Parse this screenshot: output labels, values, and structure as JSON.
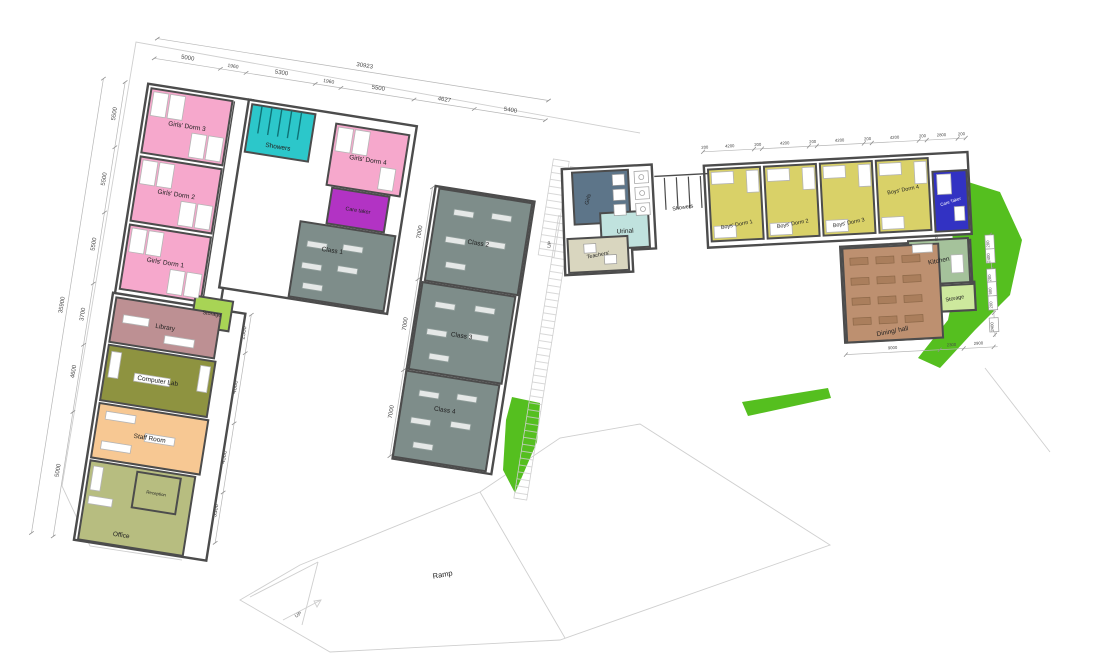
{
  "colors": {
    "green": "#55bf1f",
    "wall": "#4c4c4c",
    "pink": "#f6a8cc",
    "cyan": "#2cc7ca",
    "purple": "#b233c4",
    "class_gray": "#7e8d8a",
    "storage_green": "#a8d455",
    "library_mauve": "#bd9093",
    "lab_olive": "#8e9340",
    "staff_peach": "#f7c893",
    "office_olive": "#b7bd80",
    "toilet_slate": "#5d7589",
    "urinal_aqua": "#c0e2de",
    "teachers_beige": "#d9d6bf",
    "boys_yellow": "#d9d168",
    "caretaker_blue": "#3232c3",
    "kitchen_sage": "#a5c29b",
    "storage_light": "#cde89d",
    "dining_tan": "#bd9070"
  },
  "rooms": {
    "girls_dorm_3": {
      "label": "Girls' Dorm 3",
      "color": "#f6a8cc"
    },
    "girls_dorm_2": {
      "label": "Girls' Dorm 2",
      "color": "#f6a8cc"
    },
    "girls_dorm_1": {
      "label": "Girls' Dorm 1",
      "color": "#f6a8cc"
    },
    "girls_showers": {
      "label": "Showers",
      "color": "#2cc7ca"
    },
    "girls_dorm_4": {
      "label": "Girls' Dorm 4",
      "color": "#f6a8cc"
    },
    "care_taker_left": {
      "label": "Care taker",
      "color": "#b233c4"
    },
    "class_1": {
      "label": "Class 1",
      "color": "#7e8d8a"
    },
    "class_2": {
      "label": "Class 2",
      "color": "#7e8d8a"
    },
    "class_3": {
      "label": "Class 3",
      "color": "#7e8d8a"
    },
    "class_4": {
      "label": "Class 4",
      "color": "#7e8d8a"
    },
    "storage_left": {
      "label": "Storage",
      "color": "#a8d455"
    },
    "library": {
      "label": "Library",
      "color": "#bd9093"
    },
    "computer_lab": {
      "label": "Computer Lab",
      "color": "#8e9340"
    },
    "staff_room": {
      "label": "Staff Room",
      "color": "#f7c893"
    },
    "reception": {
      "label": "Reception",
      "color": "#b7bd80"
    },
    "office": {
      "label": "Office",
      "color": "#b7bd80"
    },
    "girls_toilets": {
      "label": "Girls",
      "color": "#5d7589"
    },
    "urinal": {
      "label": "Urinal",
      "color": "#c0e2de"
    },
    "teachers": {
      "label": "Teachers'",
      "color": "#d9d6bf"
    },
    "boys_showers": {
      "label": "Showers",
      "color": "#ffffff"
    },
    "boys_dorm_1": {
      "label": "Boys' Dorm 1",
      "color": "#d9d168"
    },
    "boys_dorm_2": {
      "label": "Boys' Dorm 2",
      "color": "#d9d168"
    },
    "boys_dorm_3": {
      "label": "Boys' Dorm 3",
      "color": "#d9d168"
    },
    "boys_dorm_4": {
      "label": "Boys' Dorm 4",
      "color": "#d9d168"
    },
    "care_taker_right": {
      "label": "Care Taker",
      "color": "#3232c3"
    },
    "kitchen": {
      "label": "Kitchen",
      "color": "#a5c29b"
    },
    "storage_right": {
      "label": "Storage",
      "color": "#cde89d"
    },
    "dining_hall": {
      "label": "Dining/ hall",
      "color": "#bd9070"
    }
  },
  "site": {
    "ramp_label": "Ramp",
    "up_ramp": "UP",
    "up_stairs": "UP",
    "dn_stairs": "DN"
  },
  "dims": {
    "top_total": "30923",
    "top": [
      "5000",
      "1960",
      "5300",
      "1960",
      "5500",
      "4627",
      "5400"
    ],
    "left_total": "35900",
    "left": [
      "5500",
      "5500",
      "5500",
      "3700",
      "4600",
      "5000"
    ],
    "mid_right": [
      "2500",
      "4600",
      "4500",
      "3300"
    ],
    "classes": [
      "7000",
      "7000",
      "7000"
    ],
    "boys_top": [
      "200",
      "4200",
      "200",
      "4200",
      "200",
      "4200",
      "200",
      "4200",
      "200",
      "2800",
      "200"
    ],
    "dining_bottom": [
      "9000",
      "2300",
      "2900"
    ],
    "right_col": [
      "200",
      "2400",
      "200",
      "900",
      "200",
      "2400"
    ],
    "care_taker_door": "900"
  }
}
